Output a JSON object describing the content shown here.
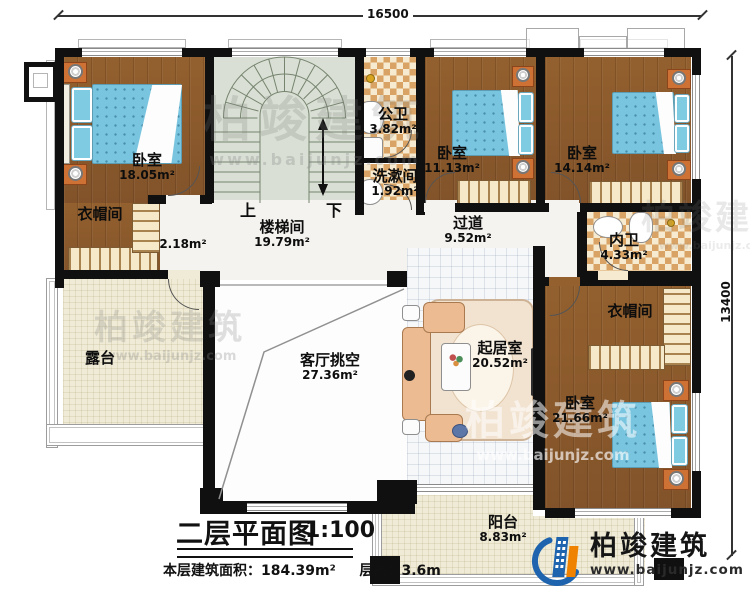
{
  "dimensions": {
    "top": "16500",
    "right": "13400"
  },
  "stairs": {
    "up": "上",
    "down": "下"
  },
  "rooms": {
    "bedroom1": {
      "name": "卧室",
      "area": "18.05m²"
    },
    "cloak1": {
      "name": "衣帽间",
      "area": "2.18m²"
    },
    "stairwell": {
      "name": "楼梯间",
      "area": "19.79m²"
    },
    "public_bath": {
      "name": "公卫",
      "area": "3.82m²"
    },
    "washroom": {
      "name": "洗漱间",
      "area": "1.92m²"
    },
    "bedroom2": {
      "name": "卧室",
      "area": "11.13m²"
    },
    "bedroom3": {
      "name": "卧室",
      "area": "14.14m²"
    },
    "corridor": {
      "name": "过道",
      "area": "9.52m²"
    },
    "inner_bath": {
      "name": "内卫",
      "area": "4.33m²"
    },
    "cloak2": {
      "name": "衣帽间"
    },
    "terrace": {
      "name": "露台"
    },
    "living_void": {
      "name": "客厅挑空",
      "area": "27.36m²"
    },
    "sitting": {
      "name": "起居室",
      "area": "20.52m²"
    },
    "bedroom4": {
      "name": "卧室",
      "area": "21.66m²"
    },
    "balcony": {
      "name": "阳台",
      "area": "8.83m²"
    }
  },
  "title": {
    "main": "二层平面图",
    "scale": "1:100"
  },
  "footer": {
    "area_label": "本层建筑面积：",
    "area_value": "184.39m²",
    "height_label": "层高：",
    "height_value": "3.6m"
  },
  "brand": {
    "name": "柏竣建筑",
    "url": "www.baijunjz.com",
    "blue": "#1d63ad",
    "orange": "#ef8200"
  }
}
